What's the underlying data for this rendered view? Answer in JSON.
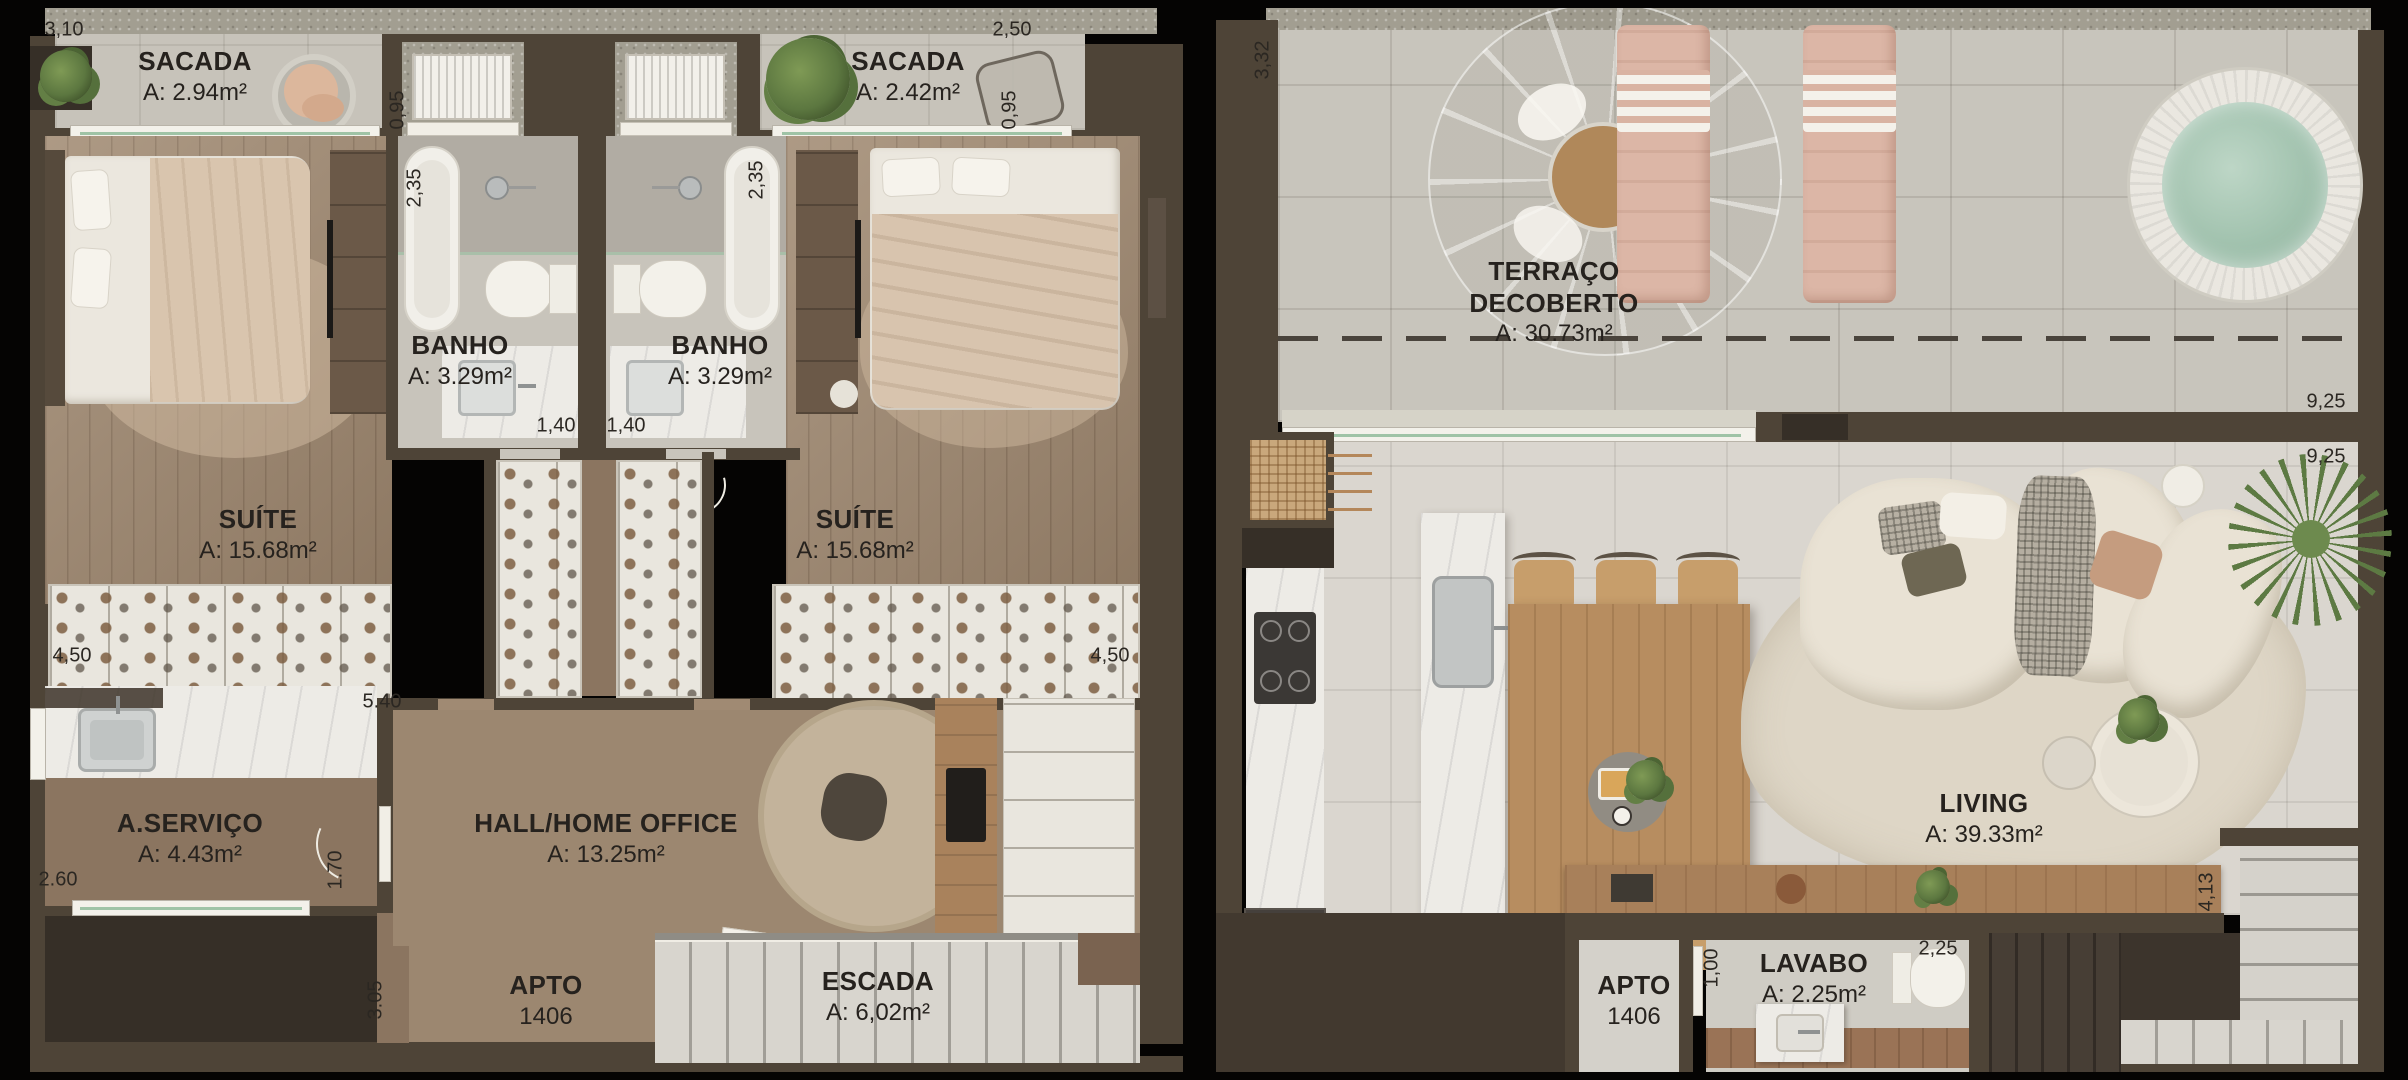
{
  "floor1": {
    "rooms": {
      "sacada_left": {
        "name": "SACADA",
        "area": "A: 2.94m²"
      },
      "sacada_right": {
        "name": "SACADA",
        "area": "A: 2.42m²"
      },
      "banho_left": {
        "name": "BANHO",
        "area": "A: 3.29m²"
      },
      "banho_right": {
        "name": "BANHO",
        "area": "A: 3.29m²"
      },
      "suite_left": {
        "name": "SUÍTE",
        "area": "A: 15.68m²"
      },
      "suite_right": {
        "name": "SUÍTE",
        "area": "A: 15.68m²"
      },
      "servico": {
        "name": "A.SERVIÇO",
        "area": "A: 4.43m²"
      },
      "hall": {
        "name": "HALL/HOME OFFICE",
        "area": "A: 13.25m²"
      },
      "escada": {
        "name": "ESCADA",
        "area": "A: 6,02m²"
      }
    },
    "apto": {
      "label": "APTO",
      "number": "1406"
    },
    "dims": {
      "top_width": "3,10",
      "sacada_left_depth": "0,95",
      "top_width_right": "2,50",
      "sacada_right_depth": "0,95",
      "banho_left_height": "2,35",
      "banho_right_height": "2,35",
      "banho_left_width": "1,40",
      "banho_right_width": "1,40",
      "suite_left_width": "4,50",
      "suite_right_width": "4,50",
      "hall_width": "5.40",
      "servico_width": "2.60",
      "servico_door": "1.70",
      "hall_depth": "3.05"
    }
  },
  "floor2": {
    "rooms": {
      "terraco": {
        "name": "TERRAÇO DECOBERTO",
        "area": "A: 30.73m²"
      },
      "living": {
        "name": "LIVING",
        "area": "A: 39.33m²"
      },
      "lavabo": {
        "name": "LAVABO",
        "area": "A: 2.25m²"
      }
    },
    "apto": {
      "label": "APTO",
      "number": "1406"
    },
    "dims": {
      "terraco_depth": "3,32",
      "terraco_width": "9,25",
      "living_width": "9,25",
      "living_depth": "4,13",
      "lavabo_door": "1,00",
      "lavabo_width": "2,25"
    }
  },
  "colors": {
    "background": "#050403",
    "wall": "#4e4437",
    "wall_dark": "#362f27",
    "concrete": "#a29e91",
    "wood_floor": "#a08a73",
    "tile_floor": "#c7c3ba",
    "tile_light": "#dad6cf",
    "marble": "#edebe6",
    "closet_white": "#e9e6de",
    "lounger_pink": "#dcb6a6",
    "spa_water": "#a6c6b2",
    "sofa_cream": "#e9e2d4",
    "table_wood": "#b78d60",
    "text": "#26221e"
  }
}
